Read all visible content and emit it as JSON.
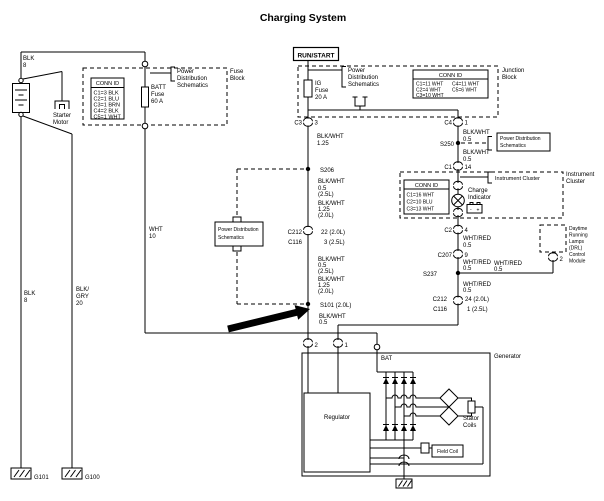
{
  "title": "Charging System",
  "battery": {
    "wire_top": [
      "BLK",
      "8"
    ],
    "starter": [
      "Starter",
      "Motor"
    ],
    "wire_left": [
      "BLK",
      "8"
    ],
    "wire_right": [
      "BLK/",
      "GRY",
      "20"
    ],
    "ground_left": "G101",
    "ground_right": "G100"
  },
  "fuse_block": {
    "label": [
      "Fuse",
      "Block"
    ],
    "fuse": [
      "BATT",
      "Fuse",
      "60 A"
    ],
    "pds": [
      "Power",
      "Distribution",
      "Schematics"
    ],
    "conn_id": {
      "header": "CONN ID",
      "rows": [
        "C1=3 BLK",
        "C2=1 BLU",
        "C3=1 BRN",
        "C4=2 BLK",
        "C5=1 WHT"
      ]
    },
    "wire_out": [
      "WHT",
      "10"
    ]
  },
  "junction_block": {
    "run_start": "RUN/START",
    "label": [
      "Junction",
      "Block"
    ],
    "fuse": [
      "IG",
      "Fuse",
      "20 A"
    ],
    "pds": [
      "Power",
      "Distribution",
      "Schematics"
    ],
    "conn_id": {
      "header": "CONN ID",
      "col1": [
        "C1=11 WHT",
        "C2=4 WHT",
        "C3=10 WHT"
      ],
      "col2": [
        "C4=11 WHT",
        "C5=6 WHT"
      ]
    },
    "c3": {
      "name": "C3",
      "pin": "3"
    },
    "c4": {
      "name": "C4",
      "pin": "1"
    }
  },
  "mid_branch": {
    "w1": [
      "BLK/WHT",
      "1.25"
    ],
    "s206": "S206",
    "w2": [
      "BLK/WHT",
      "0.5",
      "(2.5L)"
    ],
    "w3": [
      "BLK/WHT",
      "1.25",
      "(2.0L)"
    ],
    "c212": {
      "name1": "C212",
      "name2": "C116",
      "pin1": "22 (2.0L)",
      "pin2": "3 (2.5L)"
    },
    "w4": [
      "BLK/WHT",
      "0.5",
      "(2.5L)"
    ],
    "w5": [
      "BLK/WHT",
      "1.25",
      "(2.0L)"
    ],
    "s101": "S101 (2.0L)",
    "w6": [
      "BLK/WHT",
      "0.5"
    ],
    "pds_box": [
      "Power Distribution",
      "Schematics"
    ]
  },
  "right_branch": {
    "w1": [
      "BLK/WHT",
      "0.5"
    ],
    "s250": "S250",
    "pds_box": [
      "Power Distribution",
      "Schematics"
    ],
    "w2": [
      "BLK/WHT",
      "0.5"
    ],
    "c1": {
      "name": "C1",
      "pin": "14"
    },
    "c2": {
      "name": "C2",
      "pin": "4"
    },
    "w3": [
      "WHT/RED",
      "0.5"
    ],
    "c207": {
      "name": "C207",
      "pin": "9"
    },
    "w4": [
      "WHT/RED",
      "0.5"
    ],
    "s237": "S237",
    "w5": [
      "WHT/RED",
      "0.5"
    ],
    "w6": [
      "WHT/RED",
      "0.5"
    ],
    "c212": {
      "name1": "C212",
      "name2": "C116",
      "pin1": "24 (2.0L)",
      "pin2": "1 (2.5L)"
    }
  },
  "instrument_cluster": {
    "label": [
      "Instrument",
      "Cluster"
    ],
    "ref": "Instrument Cluster",
    "conn_id": {
      "header": "CONN ID",
      "rows": [
        "C1=16 WHT",
        "C2=10 BLU",
        "C3=13 WHT"
      ]
    },
    "charge_indicator": [
      "Charge",
      "Indicator"
    ],
    "battery_icon": {
      "minus": "-",
      "plus": "+"
    }
  },
  "drl": {
    "label": [
      "Daytime",
      "Running",
      "Lamps",
      "(DRL)",
      "Control",
      "Module"
    ],
    "pin": "2"
  },
  "generator": {
    "label": "Generator",
    "bat": "BAT",
    "pin2": "2",
    "pin1": "1",
    "regulator": "Regulator",
    "stator": [
      "Stator",
      "Coils"
    ],
    "field_coil": "Field Coil"
  }
}
